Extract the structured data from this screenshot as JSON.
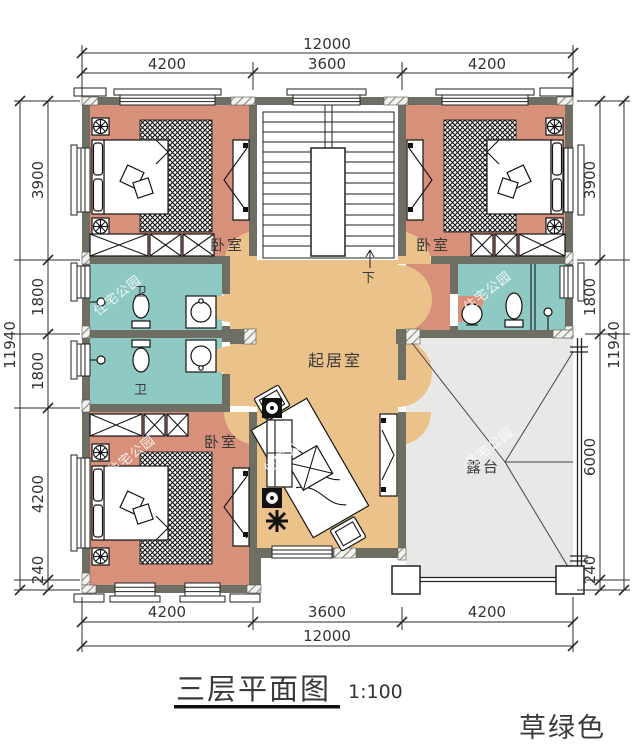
{
  "title": {
    "text": "三层平面图",
    "scale": "1:100"
  },
  "note": {
    "text": "草绿色"
  },
  "watermark": "住宅公园",
  "rooms": {
    "bedroom": "卧室",
    "bath": "卫",
    "living": "起居室",
    "terrace": "露台",
    "stair_down": "下"
  },
  "dimensions": {
    "top": {
      "total": "12000",
      "segments": [
        "4200",
        "3600",
        "4200"
      ]
    },
    "bottom": {
      "total": "12000",
      "segments": [
        "4200",
        "3600",
        "4200"
      ]
    },
    "left": {
      "total": "11940",
      "segments": [
        "3900",
        "1800",
        "1800",
        "4200",
        "240"
      ]
    },
    "right": {
      "total": "11940",
      "segments": [
        "3900",
        "1800",
        "6000",
        "240"
      ]
    }
  },
  "colors": {
    "wall": "#6e6e63",
    "bedroom": "#d7907a",
    "bath": "#8fc9c3",
    "living": "#ebc289",
    "terrace": "#e8e8e6",
    "note_green": "#7cc832"
  }
}
